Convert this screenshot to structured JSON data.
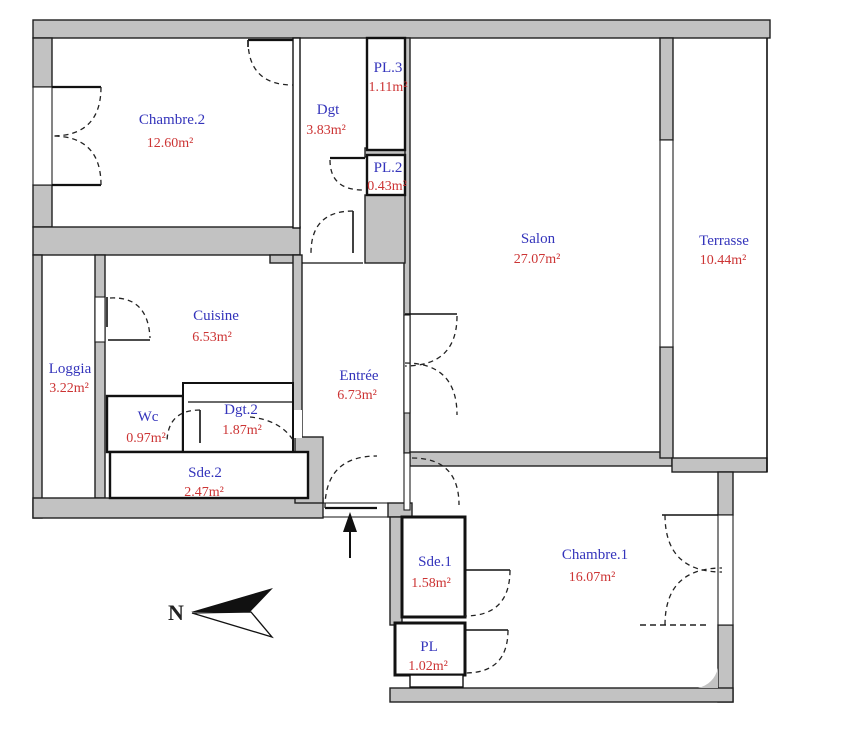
{
  "plan": {
    "compass_label": "N",
    "colors": {
      "room_name": "#3434bb",
      "room_area": "#cc3434",
      "wall_fill": "#c2c2c2",
      "wall_line": "#1f1f1f"
    },
    "rooms": [
      {
        "id": "chambre2",
        "name": "Chambre.2",
        "area": "12.60m²"
      },
      {
        "id": "dgt",
        "name": "Dgt",
        "area": "3.83m²"
      },
      {
        "id": "pl3",
        "name": "PL.3",
        "area": "1.11m²"
      },
      {
        "id": "pl2",
        "name": "PL.2",
        "area": "0.43m²"
      },
      {
        "id": "salon",
        "name": "Salon",
        "area": "27.07m²"
      },
      {
        "id": "terrasse",
        "name": "Terrasse",
        "area": "10.44m²"
      },
      {
        "id": "loggia",
        "name": "Loggia",
        "area": "3.22m²"
      },
      {
        "id": "cuisine",
        "name": "Cuisine",
        "area": "6.53m²"
      },
      {
        "id": "wc",
        "name": "Wc",
        "area": "0.97m²"
      },
      {
        "id": "dgt2",
        "name": "Dgt.2",
        "area": "1.87m²"
      },
      {
        "id": "sde2",
        "name": "Sde.2",
        "area": "2.47m²"
      },
      {
        "id": "entree",
        "name": "Entrée",
        "area": "6.73m²"
      },
      {
        "id": "sde1",
        "name": "Sde.1",
        "area": "1.58m²"
      },
      {
        "id": "chambre1",
        "name": "Chambre.1",
        "area": "16.07m²"
      },
      {
        "id": "pl",
        "name": "PL",
        "area": "1.02m²"
      }
    ]
  }
}
